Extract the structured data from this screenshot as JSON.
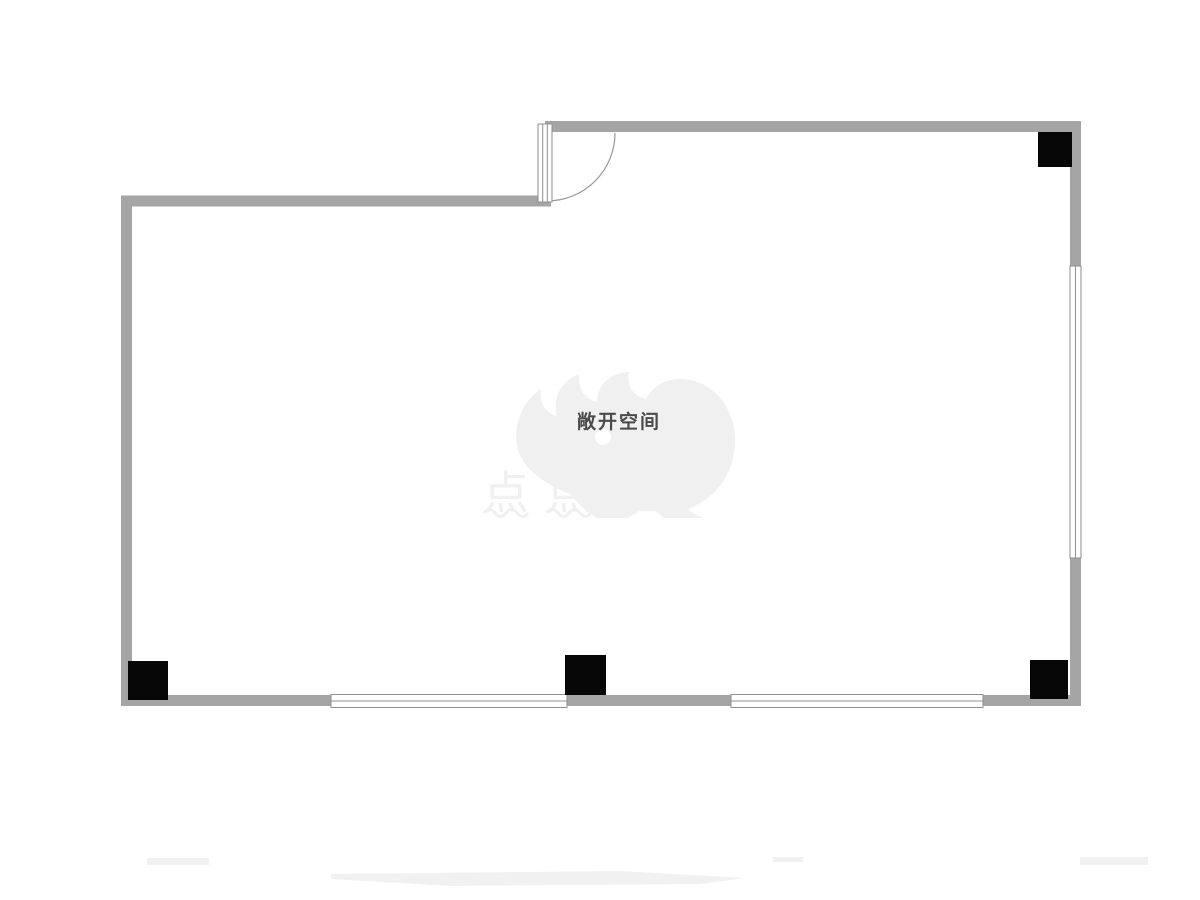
{
  "floor_plan": {
    "room_label": "敞开空间",
    "watermark": {
      "text": "点点租"
    },
    "colors": {
      "wall": "#a5a5a5",
      "column": "#060606",
      "window_line": "#8f8f8f",
      "door_line": "#9a9a9a",
      "room_label_color": "#4a4a4a",
      "watermark_color": "#f0f0f0",
      "smudge": "#f1f1f1",
      "background": "#ffffff"
    }
  }
}
